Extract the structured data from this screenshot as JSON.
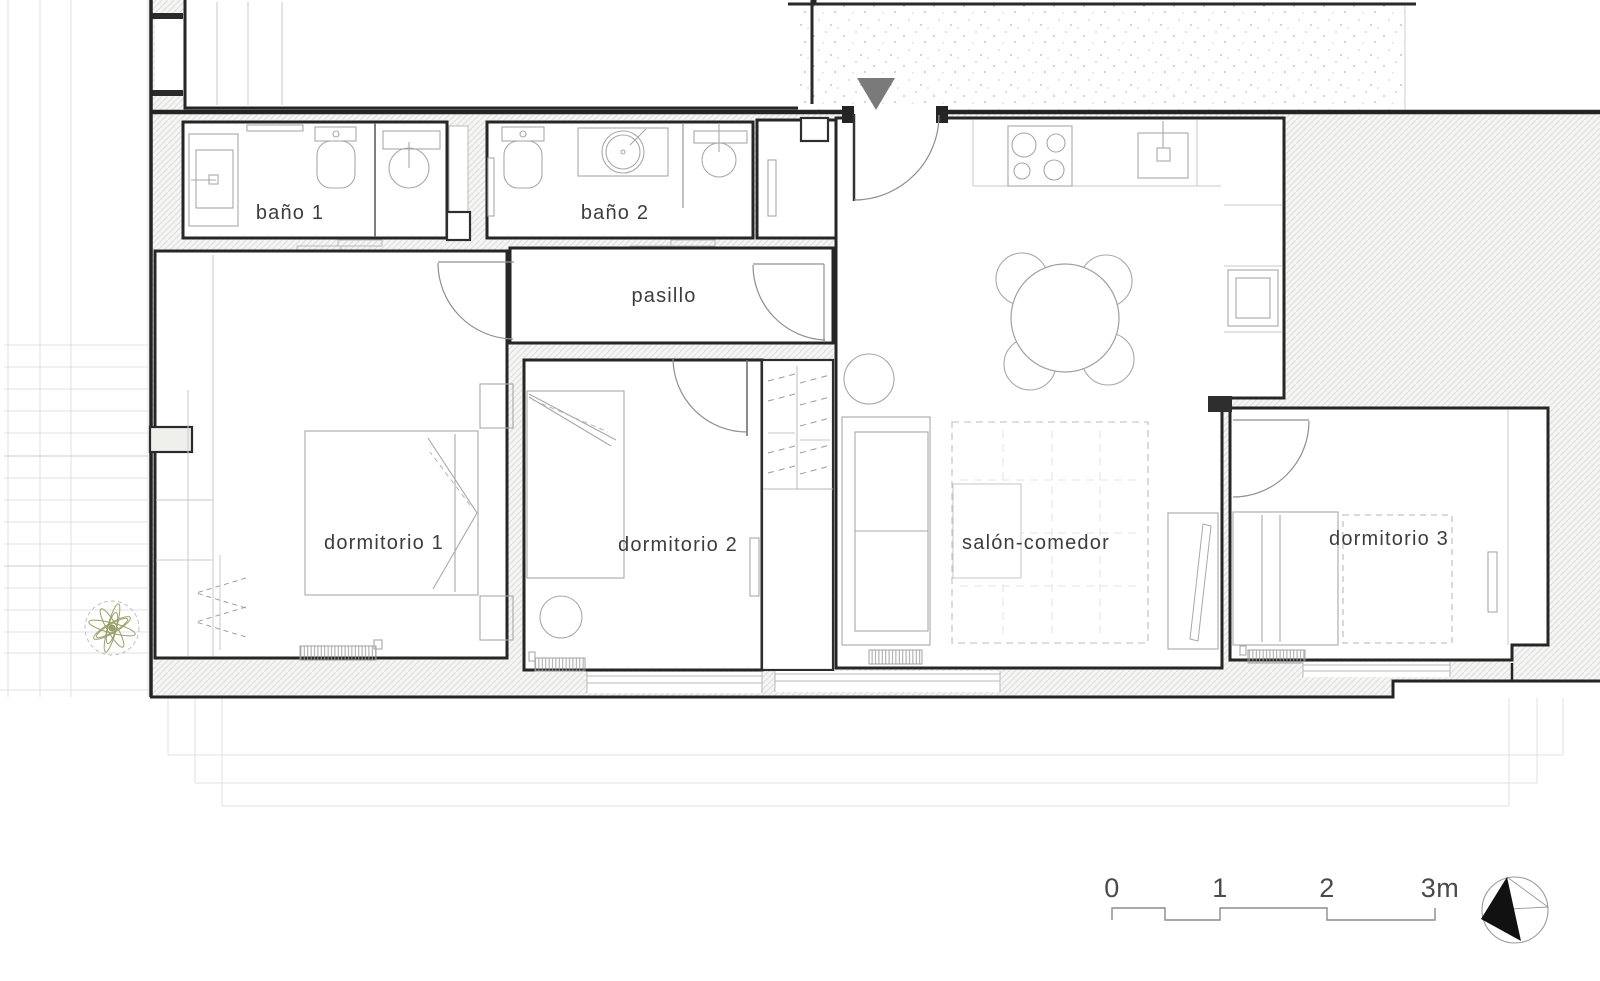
{
  "document": {
    "type": "architectural-floor-plan",
    "style": "apartment plan, black walls on white, light hatching"
  },
  "rooms": {
    "bano1": {
      "label": "baño 1"
    },
    "bano2": {
      "label": "baño 2"
    },
    "pasillo": {
      "label": "pasillo"
    },
    "dormitorio1": {
      "label": "dormitorio 1"
    },
    "dormitorio2": {
      "label": "dormitorio 2"
    },
    "salon_comedor": {
      "label": "salón-comedor"
    },
    "dormitorio3": {
      "label": "dormitorio 3"
    }
  },
  "scale_bar": {
    "t0": "0",
    "t1": "1",
    "t2": "2",
    "t3": "3m"
  },
  "icons": {
    "entrance_marker": "entrance-triangle-icon",
    "north_compass": "north-arrow-icon",
    "plant": "plant-icon"
  },
  "colors": {
    "wall": "#262626",
    "furniture": "#a8a8a8",
    "hatch": "#dedddb",
    "entrance_arrow": "#7a7a7a",
    "plant_green": "#9aa06b",
    "north_black": "#111111"
  }
}
